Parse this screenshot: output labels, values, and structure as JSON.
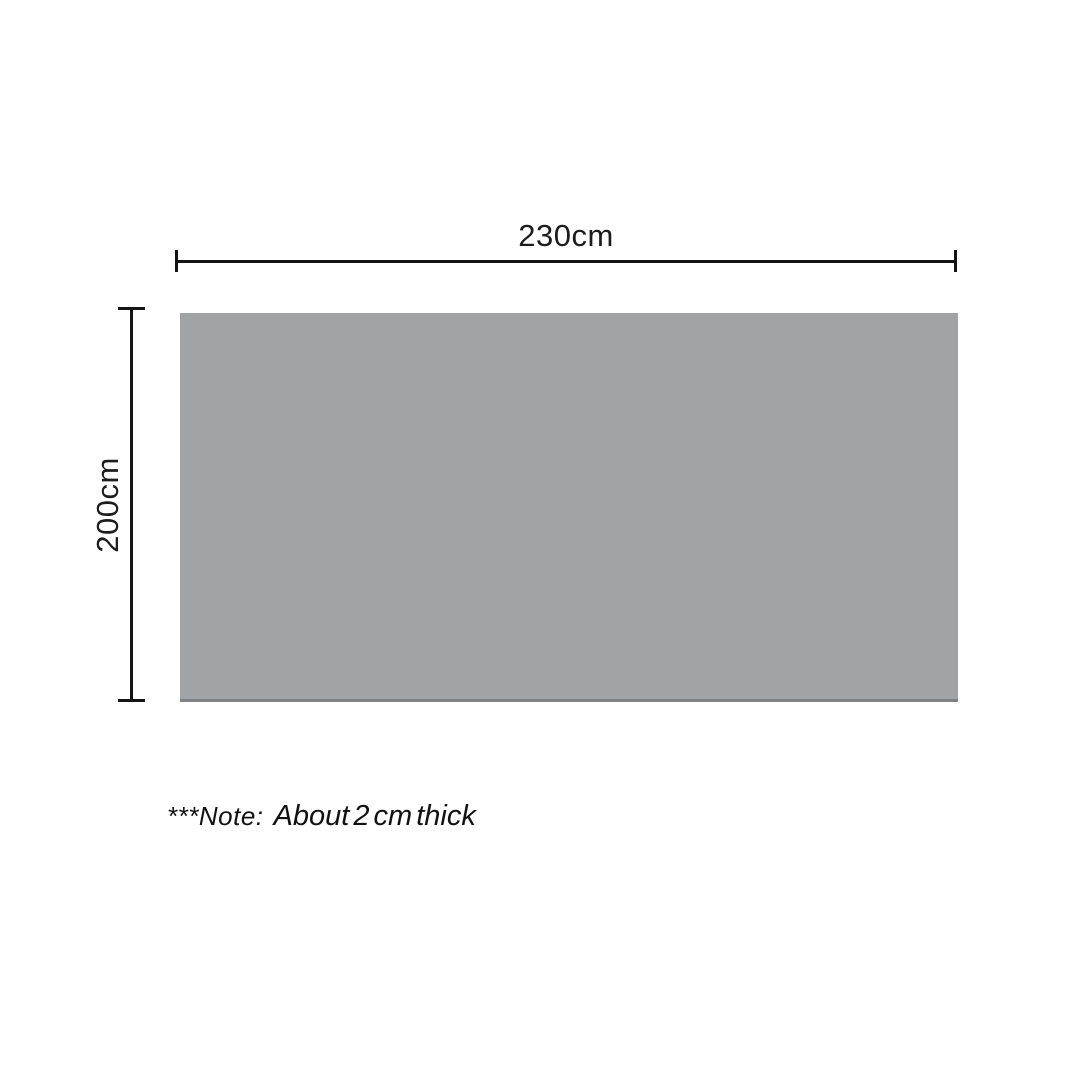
{
  "diagram": {
    "type": "product-dimension-diagram",
    "width_label": "230cm",
    "height_label": "200cm",
    "note": {
      "prefix": "***Note:",
      "text": "About 2 cm thick"
    },
    "colors": {
      "rectangle_fill": "#a0a4a7",
      "rectangle_bottom_edge": "#7f8386",
      "dimension_line": "#141414",
      "text": "#1c1c1c",
      "background": "#ffffff"
    }
  }
}
